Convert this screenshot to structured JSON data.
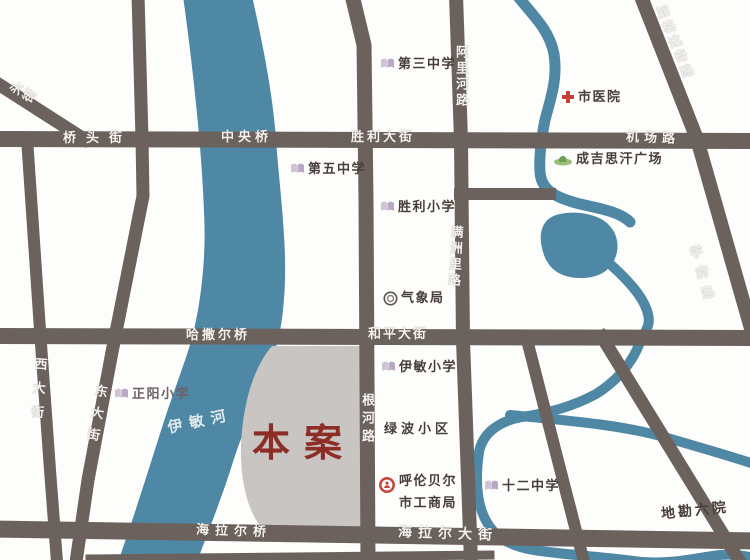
{
  "map": {
    "site_label": "本案",
    "river_label": "伊敏河",
    "colors": {
      "river": "#4E88A5",
      "road": "#6B625D",
      "site_area": "#C9C5C2",
      "site_text": "#8C2D28",
      "poi_text": "#473E39",
      "road_text": "#FFFFFF",
      "hospital_icon": "#C64238",
      "square_icon": "#8FB46A",
      "school_icon": "#B9A8C4"
    },
    "road_labels": {
      "qiaotou_street": "桥头街",
      "zhongyang_bridge": "中央桥",
      "shengli_avenue": "胜利大街",
      "jichang_road": "机场路",
      "jiagedaqi_road": "加格达奇路",
      "alihe_road": "阿里河路",
      "manzhouli_road": "满洲里路",
      "xuefu_road": "学府路",
      "hasaer_bridge": "哈撒尔桥",
      "heping_avenue": "和平大街",
      "xi_avenue": "西大街",
      "dong_avenue": "东大街",
      "genhe_road": "根河路",
      "hailaer_bridge": "海拉尔桥",
      "hailaer_avenue": "海拉尔大街",
      "corner_street_partial": "头街"
    },
    "pois": {
      "no3_middle_school": "第三中学",
      "city_hospital": "市医院",
      "genghis_khan_square": "成吉思汗广场",
      "no5_middle_school": "第五中学",
      "shengli_primary_school": "胜利小学",
      "weather_bureau": "气象局",
      "zhengyang_primary_school": "正阳小学",
      "yimin_primary_school": "伊敏小学",
      "lvbo_block": "绿波小区",
      "gongshang_line1": "呼伦贝尔",
      "gongshang_line2": "市工商局",
      "no12_middle_school": "十二中学",
      "dikan_institute": "地勘六院"
    }
  }
}
